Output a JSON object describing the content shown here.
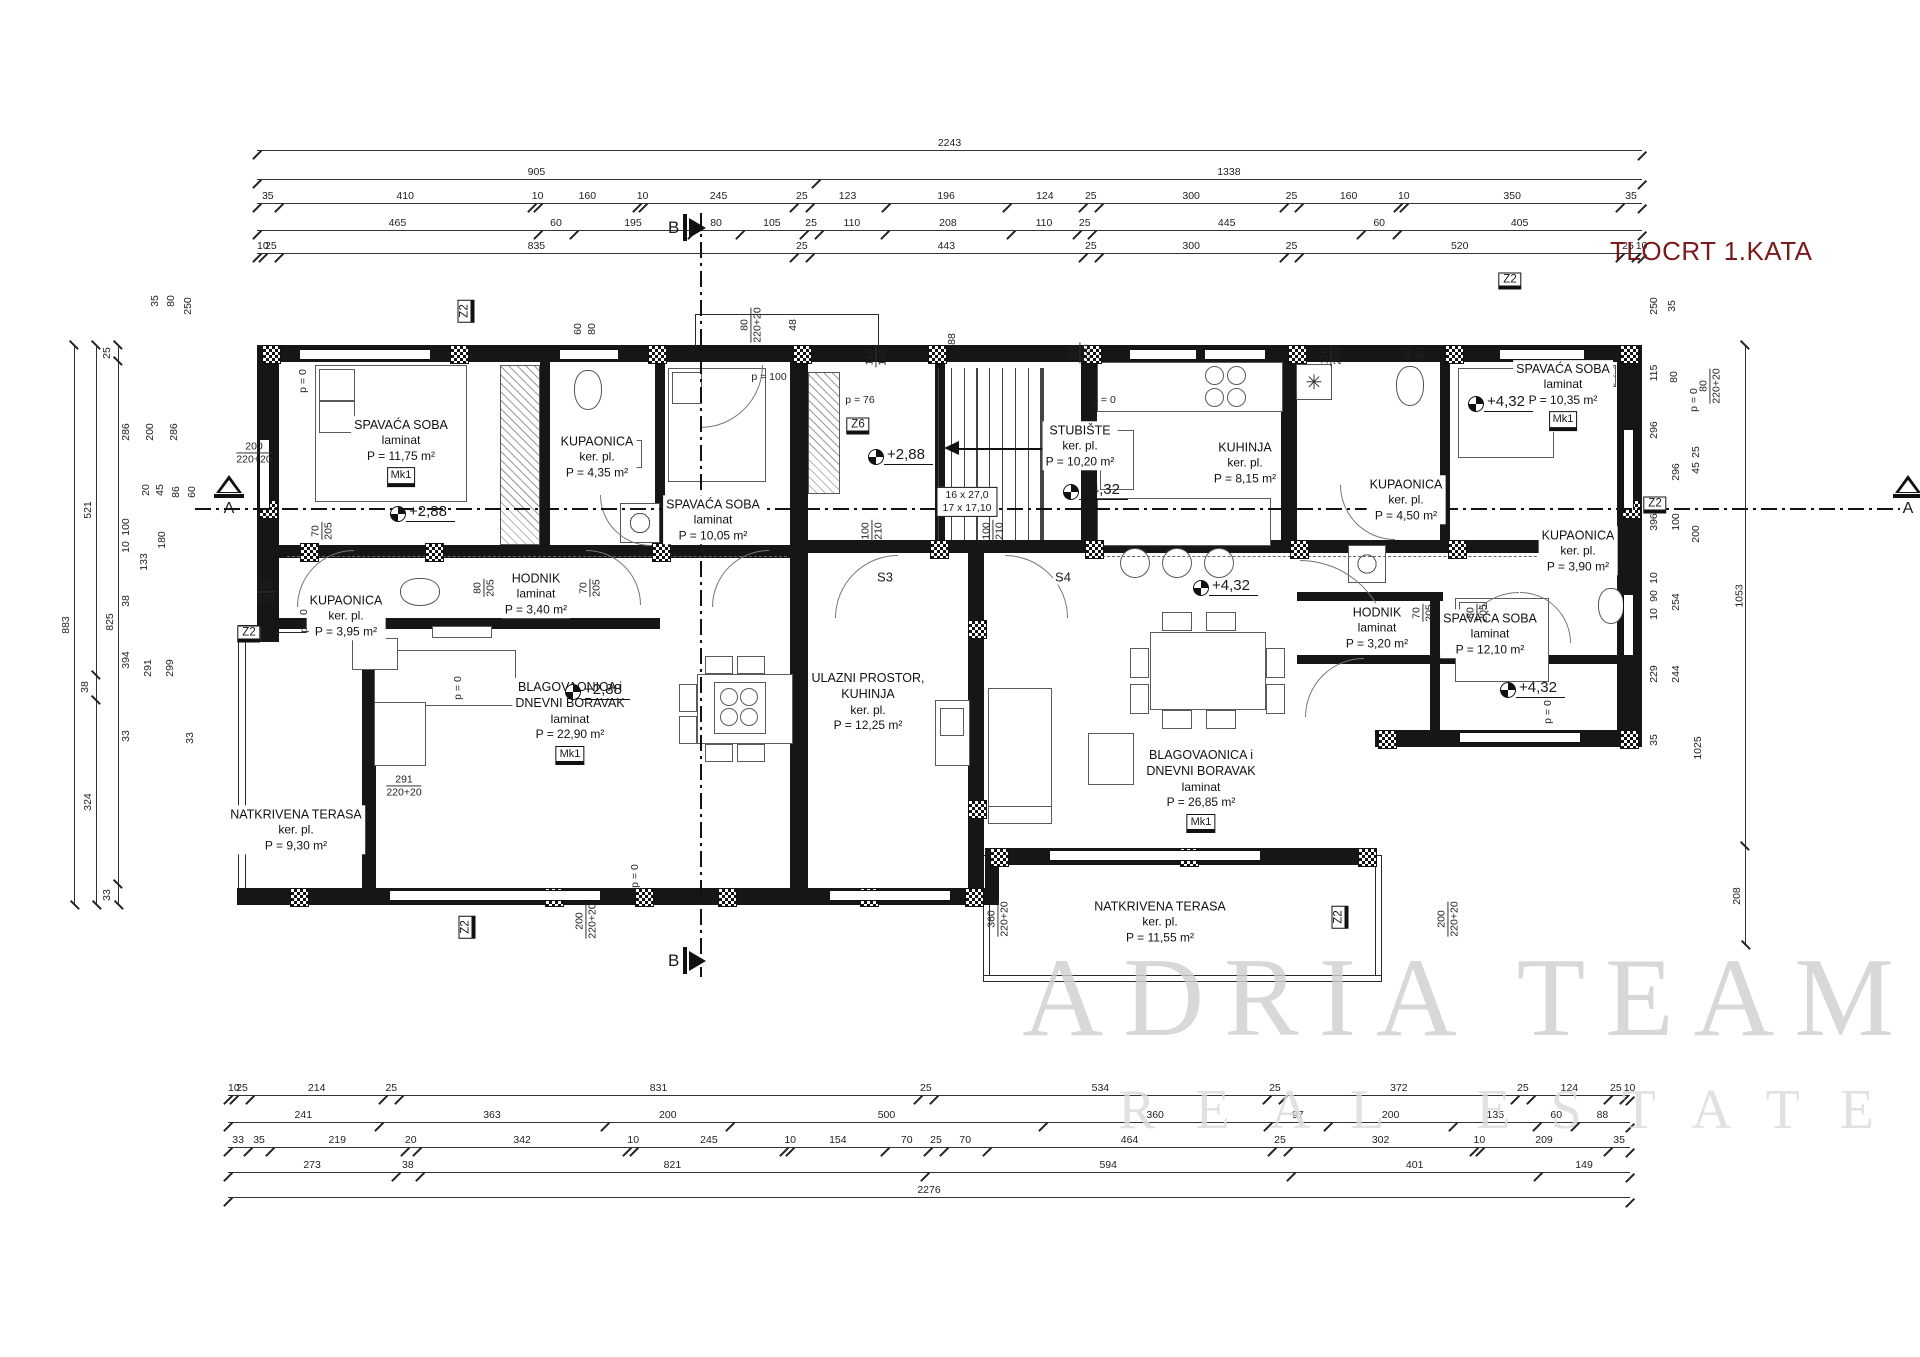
{
  "title": "TLOCRT 1.KATA",
  "watermark": {
    "line1": "ADRIA TEAM",
    "line2": "REAL ESTATE"
  },
  "rooms": [
    {
      "id": "r1",
      "name": "SPAVAĆA SOBA",
      "floor": "laminat",
      "area": "P = 11,75 m²",
      "badge": "Mk1"
    },
    {
      "id": "r2",
      "name": "KUPAONICA",
      "floor": "ker. pl.",
      "area": "P = 4,35 m²"
    },
    {
      "id": "r3",
      "name": "SPAVAĆA SOBA",
      "floor": "laminat",
      "area": "P = 10,05 m²"
    },
    {
      "id": "r4",
      "name": "HODNIK",
      "floor": "laminat",
      "area": "P = 3,40 m²"
    },
    {
      "id": "r5",
      "name": "KUPAONICA",
      "floor": "ker. pl.",
      "area": "P = 3,95 m²"
    },
    {
      "id": "r6",
      "name": "NATKRIVENA TERASA",
      "floor": "ker. pl.",
      "area": "P = 9,30 m²"
    },
    {
      "id": "r7",
      "name": "BLAGOVAONICA i",
      "name2": "DNEVNI BORAVAK",
      "floor": "laminat",
      "area": "P = 22,90 m²",
      "badge": "Mk1"
    },
    {
      "id": "r8",
      "name": "ULAZNI PROSTOR,",
      "name2": "KUHINJA",
      "floor": "ker. pl.",
      "area": "P = 12,25 m²"
    },
    {
      "id": "r9",
      "name": "STUBIŠTE",
      "floor": "ker. pl.",
      "area": "P = 10,20 m²"
    },
    {
      "id": "r10",
      "name": "KUHINJA",
      "floor": "ker. pl.",
      "area": "P = 8,15 m²"
    },
    {
      "id": "r11",
      "name": "KUPAONICA",
      "floor": "ker. pl.",
      "area": "P = 4,50 m²"
    },
    {
      "id": "r12",
      "name": "SPAVAĆA SOBA",
      "floor": "laminat",
      "area": "P = 10,35 m²",
      "badge": "Mk1"
    },
    {
      "id": "r13",
      "name": "HODNIK",
      "floor": "laminat",
      "area": "P = 3,20 m²"
    },
    {
      "id": "r14",
      "name": "KUPAONICA",
      "floor": "ker. pl.",
      "area": "P = 3,90 m²"
    },
    {
      "id": "r15",
      "name": "BLAGOVAONICA i",
      "name2": "DNEVNI BORAVAK",
      "floor": "laminat",
      "area": "P = 26,85 m²",
      "badge": "Mk1"
    },
    {
      "id": "r16",
      "name": "SPAVAĆA SOBA",
      "floor": "laminat",
      "area": "P = 12,10 m²"
    },
    {
      "id": "r17",
      "name": "NATKRIVENA TERASA",
      "floor": "ker. pl.",
      "area": "P = 11,55 m²"
    }
  ],
  "levels": [
    {
      "id": "l1",
      "text": "+2,88"
    },
    {
      "id": "l2",
      "text": "+2,88"
    },
    {
      "id": "l3",
      "text": "+2,88"
    },
    {
      "id": "l4",
      "text": "+4,32"
    },
    {
      "id": "l5",
      "text": "+4,32"
    },
    {
      "id": "l6",
      "text": "+4,32"
    },
    {
      "id": "l7",
      "text": "+4,32"
    }
  ],
  "zone_marks": [
    {
      "id": "z2a",
      "text": "Z2"
    },
    {
      "id": "z2b",
      "text": "Z2"
    },
    {
      "id": "z6",
      "text": "Z6"
    },
    {
      "id": "z2c",
      "text": "Z2"
    },
    {
      "id": "z2d",
      "text": "Z2"
    },
    {
      "id": "z2e",
      "text": "Z2"
    },
    {
      "id": "z2f",
      "text": "Z2"
    }
  ],
  "stair_note": {
    "line1": "16 x 27,0",
    "line2": "17 x 17,10"
  },
  "door_marks": [
    {
      "id": "s3",
      "text": "S3"
    },
    {
      "id": "s4",
      "text": "S4"
    }
  ],
  "section_marks": {
    "a": "A",
    "b": "B"
  },
  "annotations": [
    {
      "id": "a1",
      "top": "200",
      "bottom": "220+20"
    },
    {
      "id": "a2",
      "top": "70",
      "bottom": "205"
    },
    {
      "id": "a3",
      "top": "60",
      "bottom": "220"
    },
    {
      "id": "a4",
      "top": "80",
      "bottom": "205"
    },
    {
      "id": "a5",
      "top": "70",
      "bottom": "205"
    },
    {
      "id": "a6a",
      "text": "60"
    },
    {
      "id": "a6b",
      "text": "80"
    },
    {
      "id": "a7",
      "top": "80",
      "bottom": "220+20"
    },
    {
      "id": "a8",
      "text": "48"
    },
    {
      "id": "a9",
      "text": "p = 100"
    },
    {
      "id": "a10",
      "top": "110",
      "bottom": "144"
    },
    {
      "id": "a11",
      "text": "88"
    },
    {
      "id": "a12",
      "text": "p = 76"
    },
    {
      "id": "a13",
      "top": "110",
      "bottom": "220"
    },
    {
      "id": "a14",
      "text": "p = 0"
    },
    {
      "id": "a15",
      "top": "110",
      "bottom": "220"
    },
    {
      "id": "a16a",
      "text": "60"
    },
    {
      "id": "a16b",
      "text": "80"
    },
    {
      "id": "a17",
      "top": "100",
      "bottom": "210"
    },
    {
      "id": "a18",
      "top": "100",
      "bottom": "210"
    },
    {
      "id": "a19",
      "text": "p = 0"
    },
    {
      "id": "a20",
      "text": "p = 0"
    },
    {
      "id": "a21",
      "text": "p = 0"
    },
    {
      "id": "a22",
      "top": "291",
      "bottom": "220+20"
    },
    {
      "id": "a23",
      "top": "200",
      "bottom": "220+20"
    },
    {
      "id": "a24",
      "text": "p = 0"
    },
    {
      "id": "a25",
      "top": "360",
      "bottom": "220+20"
    },
    {
      "id": "a26",
      "top": "200",
      "bottom": "220+20"
    },
    {
      "id": "a27",
      "top": "80",
      "bottom": "220+20"
    },
    {
      "id": "a28",
      "text": "p = 0"
    },
    {
      "id": "a29",
      "top": "70",
      "bottom": "205"
    },
    {
      "id": "a30",
      "top": "80",
      "bottom": "205"
    },
    {
      "id": "a31",
      "text": "p = 0"
    }
  ],
  "dimensions": {
    "top_rows": [
      [
        2243
      ],
      [
        905,
        1338
      ],
      [
        35,
        410,
        10,
        160,
        10,
        245,
        25,
        123,
        196,
        124,
        25,
        300,
        25,
        160,
        10,
        350,
        35
      ],
      [
        465,
        60,
        195,
        80,
        105,
        25,
        110,
        208,
        110,
        25,
        445,
        60,
        405
      ],
      [
        10,
        25,
        835,
        25,
        443,
        25,
        300,
        25,
        520,
        25,
        10
      ]
    ],
    "bottom_rows": [
      [
        10,
        25,
        214,
        25,
        831,
        25,
        534,
        25,
        372,
        25,
        124,
        25,
        10
      ],
      [
        241,
        363,
        200,
        500,
        360,
        97,
        200,
        135,
        60,
        88
      ],
      [
        33,
        35,
        219,
        20,
        342,
        10,
        245,
        10,
        154,
        70,
        25,
        70,
        464,
        25,
        302,
        10,
        209,
        35
      ],
      [
        273,
        38,
        821,
        594,
        401,
        149
      ],
      [
        2276
      ]
    ],
    "left_cols": [
      [
        883
      ],
      [
        521,
        38,
        324
      ],
      [
        25,
        825,
        33
      ]
    ],
    "right_cols": [
      [
        1053,
        208
      ]
    ],
    "left_misc": [
      "35",
      "80",
      "250",
      "286",
      "200",
      "286",
      "20",
      "45",
      "86",
      "60",
      "100",
      "10",
      "180",
      "133",
      "38",
      "394",
      "291",
      "299",
      "33",
      "33"
    ],
    "right_misc": [
      "250",
      "35",
      "115",
      "80",
      "296",
      "296",
      "25",
      "45",
      "396",
      "100",
      "200",
      "10",
      "90",
      "10",
      "254",
      "229",
      "244",
      "35",
      "1025"
    ]
  }
}
